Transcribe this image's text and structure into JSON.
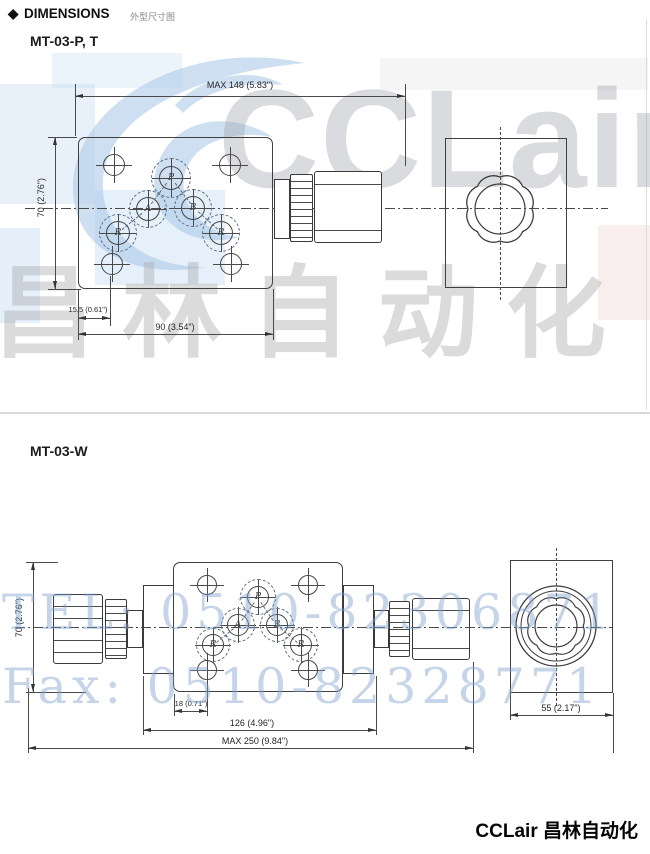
{
  "header": {
    "diamond_icon": "◆",
    "title": "DIMENSIONS",
    "subtitle_cn": "外型尺寸图"
  },
  "sections": [
    {
      "title": "MT-03-P, T",
      "dims": {
        "max_length": "MAX  148 (5.83\")",
        "height": "70 (2.76\")",
        "hole_offset": "15.5 (0.61\")",
        "plate_width": "90 (3.54\")"
      },
      "ports": {
        "p": "P",
        "a": "A",
        "b": "B",
        "r_left": "R",
        "r_right": "R"
      }
    },
    {
      "title": "MT-03-W",
      "dims": {
        "height": "70 (2.76\")",
        "hole_offset": "18 (0.71\")",
        "body_length": "126 (4.96\")",
        "max_length": "MAX  250 (9.84\")",
        "end_width": "55 (2.17\")"
      },
      "ports": {
        "p": "P",
        "a": "A",
        "b": "B",
        "r_left": "R",
        "r_right": "R"
      }
    }
  ],
  "watermark": {
    "brand_latin": "CCLair",
    "brand_cn": "昌林自动化",
    "tel": "TEL: 0510-82306871",
    "fax": "Fax: 0510-82328771",
    "blue": "#aecbe8",
    "grey": "#d2d2d2"
  },
  "footer": {
    "brand": "CCLair 昌林自动化"
  }
}
